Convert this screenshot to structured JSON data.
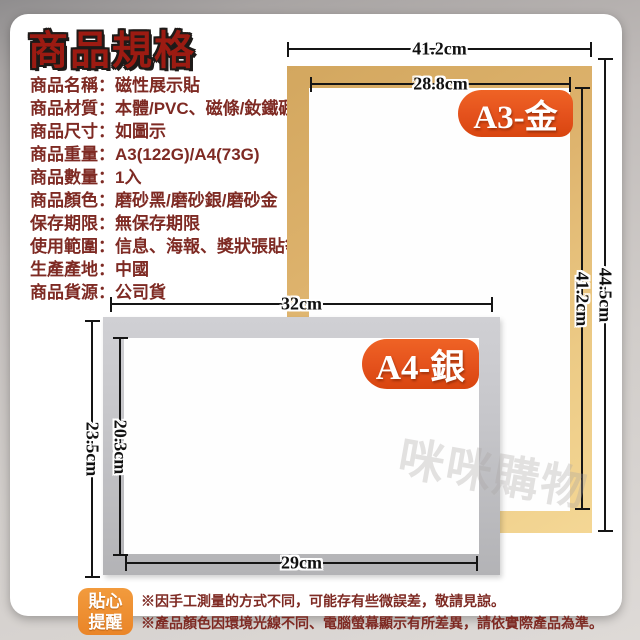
{
  "ui": {
    "colon": "："
  },
  "title": "商品規格",
  "specs": [
    {
      "label": "商品名稱",
      "value": "磁性展示貼"
    },
    {
      "label": "商品材質",
      "value": "本體/PVC、磁條/釹鐵硼"
    },
    {
      "label": "商品尺寸",
      "value": "如圖示"
    },
    {
      "label": "商品重量",
      "value": "A3(122G)/A4(73G)"
    },
    {
      "label": "商品數量",
      "value": "1入"
    },
    {
      "label": "商品顏色",
      "value": "磨砂黑/磨砂銀/磨砂金"
    },
    {
      "label": "保存期限",
      "value": "無保存期限"
    },
    {
      "label": "使用範圍",
      "value": "信息、海報、獎狀張貼等"
    },
    {
      "label": "生產產地",
      "value": "中國"
    },
    {
      "label": "商品貨源",
      "value": "公司貨"
    }
  ],
  "frames": {
    "a3": {
      "badge": "A3-金",
      "outer_width": "41.2cm",
      "inner_width": "28.8cm",
      "outer_height": "44.5cm",
      "inner_height": "41.2cm"
    },
    "a4": {
      "badge": "A4-銀",
      "outer_width": "32cm",
      "inner_width": "29cm",
      "outer_height": "23.5cm",
      "inner_height": "20.3cm"
    }
  },
  "reminder": {
    "badge": [
      "貼心",
      "提醒"
    ],
    "notes": [
      "※因手工測量的方式不同，可能存有些微誤差，敬請見諒。",
      "※產品顏色因環境光線不同、電腦螢幕顯示有所差異，請依實際產品為準。"
    ]
  },
  "watermark": "咪咪購物",
  "colors": {
    "title_red": "#9c1b12",
    "spec_text_red": "#7e2a23",
    "gold_frame": "#ddb26c",
    "gold_frame_light": "#f4d795",
    "silver_frame": "#c6c6ca",
    "silver_frame_dark": "#b3b3b6",
    "badge_orange": "#e4511c",
    "reminder_orange": "#ea8528",
    "measure_line_black": "#151515"
  }
}
